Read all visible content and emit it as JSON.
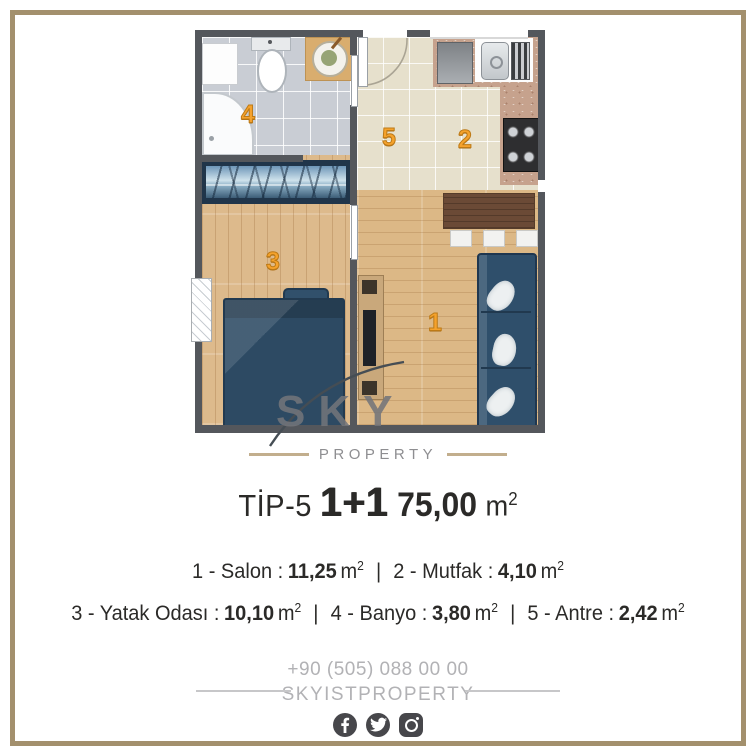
{
  "colors": {
    "frame": "#a3906d",
    "wall": "#54575c",
    "tile_gray": "#c9cdd4",
    "tile_beige": "#e6e0cc",
    "wood": "#dcb886",
    "navy_furniture": "#2d4a63",
    "room_number": "#f5a22c",
    "text_dark": "#2b2a28",
    "footer_gray": "#b2b2b5",
    "icon_gray": "#47474b"
  },
  "plan": {
    "room_numbers": [
      "1",
      "2",
      "3",
      "4",
      "5"
    ]
  },
  "logo": {
    "text": "SKY",
    "subtext": "PROPERTY"
  },
  "title": {
    "prefix": "TİP-5",
    "type": "1+1",
    "area": "75,00",
    "unit_base": "m",
    "unit_sup": "2"
  },
  "details": {
    "separator": "|",
    "rooms": [
      {
        "label": "1 - Salon :",
        "value": "11,25",
        "unit_base": "m",
        "unit_sup": "2"
      },
      {
        "label": "2 - Mutfak :",
        "value": "4,10",
        "unit_base": "m",
        "unit_sup": "2"
      },
      {
        "label": "3 - Yatak Odası :",
        "value": "10,10",
        "unit_base": "m",
        "unit_sup": "2"
      },
      {
        "label": "4 - Banyo :",
        "value": "3,80",
        "unit_base": "m",
        "unit_sup": "2"
      },
      {
        "label": "5 - Antre :",
        "value": "2,42",
        "unit_base": "m",
        "unit_sup": "2"
      }
    ]
  },
  "footer": {
    "phone": "+90 (505) 088 00 00",
    "handle": "SKYISTPROPERTY",
    "social": [
      "facebook",
      "twitter",
      "instagram"
    ]
  }
}
